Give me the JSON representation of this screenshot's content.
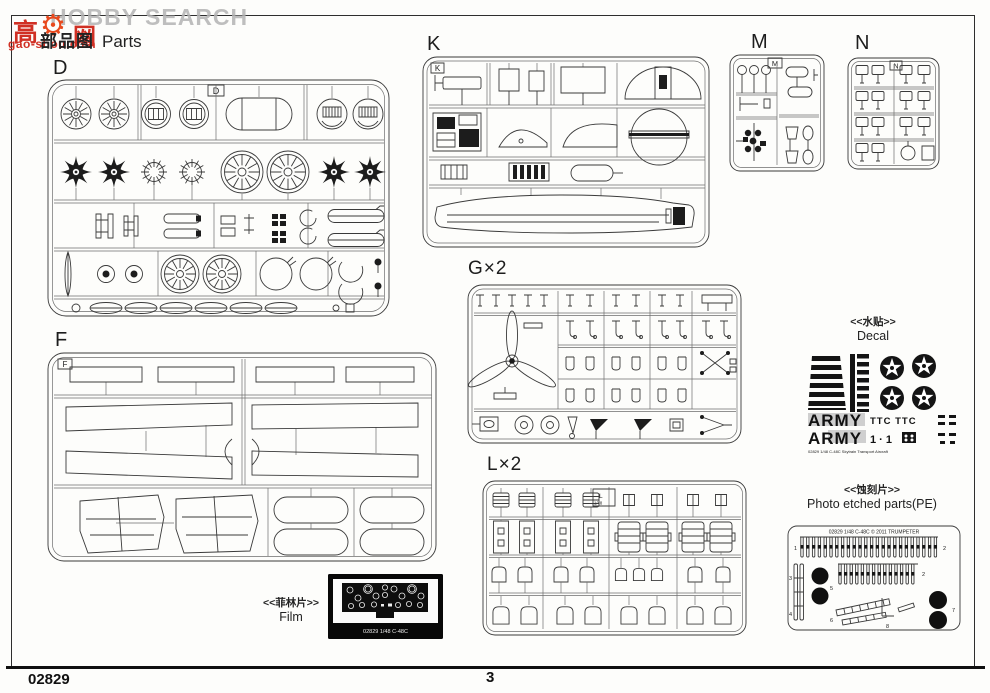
{
  "page": {
    "title_cn": "部品图",
    "title_en": "Parts",
    "footer_code": "02829",
    "page_number": "3"
  },
  "watermark": {
    "logo_left": "高",
    "logo_right": "网",
    "gear_icon": "⚙",
    "gray_text": "HOBBY SEARCH",
    "url_text": "gao-shou.com",
    "red": "#d03024",
    "gray": "#b4b4b4"
  },
  "sprues": {
    "d": {
      "label": "D",
      "tag": "D"
    },
    "f": {
      "label": "F",
      "tag": "F"
    },
    "k": {
      "label": "K",
      "tag": "K"
    },
    "m": {
      "label": "M",
      "tag": "M"
    },
    "n": {
      "label": "N",
      "tag": "N"
    },
    "g": {
      "label": "G×2"
    },
    "l": {
      "label": "L×2",
      "tag": "L",
      "tag_scale": "1/48"
    }
  },
  "sections": {
    "decal": {
      "heading_cn": "<<水贴>>",
      "heading_en": "Decal",
      "army": "ARMY",
      "ttc": "TTC TTC",
      "ones": "1 · 1",
      "caption": "02829 1/48 C-48C Skytrain Transport Aircraft"
    },
    "pe": {
      "heading_cn": "<<蚀刻片>>",
      "heading_en": "Photo etched parts(PE)",
      "fret_title": "02829 1/48 C-48C © 2011 TRUMPETER",
      "nums": [
        "1",
        "2",
        "3",
        "4",
        "5",
        "6",
        "7",
        "8"
      ]
    },
    "film": {
      "heading_cn": "<<菲林片>>",
      "heading_en": "Film",
      "caption": "02829 1/48 C-48C"
    }
  },
  "colors": {
    "ink": "#3a3a3a",
    "runner": "#6e6e6e",
    "paper": "#fdfdfb",
    "decal_black": "#141414"
  }
}
